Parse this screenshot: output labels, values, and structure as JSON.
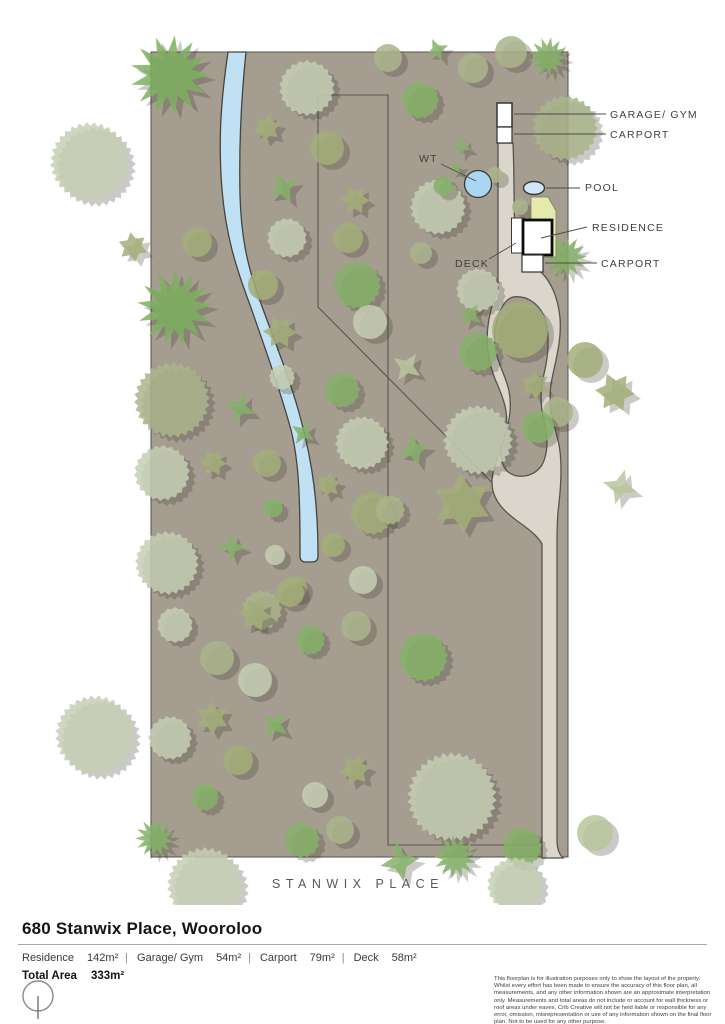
{
  "footer": {
    "title": "680 Stanwix Place, Wooroloo",
    "areas": [
      {
        "label": "Residence",
        "value": "142m²"
      },
      {
        "label": "Garage/ Gym",
        "value": "54m²"
      },
      {
        "label": "Carport",
        "value": "79m²"
      },
      {
        "label": "Deck",
        "value": "58m²"
      }
    ],
    "total_label": "Total Area",
    "total_value": "333m²",
    "disclaimer": "This floorplan is for illustration purposes only to show the layout of the property. Whilst every effort has been made to ensure the accuracy of this floor plan, all measurements, and any other information shown are an approximate interpretation only. Measurements and total areas do not include or account for wall thickness or roof areas under eaves. Crib Creative will not be held liable or responsible for any error, omission, misrepresentation or use of any information shown on the final floor plan. Not to be used for any other purpose.",
    "website": "www.cribcreative.com.au"
  },
  "map": {
    "width": 725,
    "height": 905,
    "lot": {
      "x": 151,
      "y": 52,
      "w": 417,
      "h": 805,
      "fill": "#a69d91",
      "stroke": "#55514a"
    },
    "creek_d": "M 228,52 C 221,100 218,140 222,190 C 226,235 235,265 250,305 C 264,345 280,390 291,430 C 298,458 300,490 300,545 L 300,556 Q 300,562 306,562 L 312,562 Q 318,562 318,556 C 318,505 313,465 301,420 C 290,378 272,335 259,298 C 247,265 241,235 240,195 C 239,150 241,100 246,52 Z",
    "creek_fill": "#bfe1f3",
    "creek_stroke": "#45433d",
    "fence": [
      "M 318,95 L 388,95 L 388,845 L 534,845 Q 542,845 542,836 L 542,535",
      "M 318,95 L 318,307 L 542,533"
    ],
    "fence_stroke": "#5b564e",
    "driveway_d": "M 498,143 L 513,143 C 515,190 513,235 517,252 L 540,252 L 541,272 C 551,282 558,297 560,318 C 562,341 555,362 551,384 C 548,405 553,421 558,440 C 563,460 561,488 558,512 C 557,526 557,534 557,544 L 557,840 C 557,848 559,854 563,858 L 542,858 L 542,544 C 537,535 527,528 516,520 C 501,509 491,497 492,480 C 493,464 502,450 506,431 C 509,412 503,397 495,379 C 488,361 485,340 489,319 C 492,305 494,297 498,290 Z M 513,297 C 527,295 541,304 546,322 C 550,339 548,357 544,374 C 540,390 540,405 544,421 C 548,438 548,454 542,465 C 534,477 517,480 507,471 C 499,462 500,449 505,435 C 510,420 512,406 509,391 C 506,376 497,363 495,346 C 493,326 500,301 513,297 Z",
    "driveway_fill": "#dbd6cc",
    "driveway_stroke": "#57534b",
    "lawn_d": "M 531,197 L 548,197 L 556,211 L 556,257 L 531,257 Z",
    "lawn_fill": "#e4eaac",
    "lawn_stroke": "#77775a",
    "buildings": [
      {
        "name": "garage-gym",
        "x": 497,
        "y": 103,
        "w": 15,
        "h": 24,
        "stroke": "#35332e",
        "sw": 1.5
      },
      {
        "name": "carport-top",
        "x": 497,
        "y": 127,
        "w": 15,
        "h": 16,
        "stroke": "#35332e",
        "sw": 1.2
      },
      {
        "name": "deck",
        "x": 511.5,
        "y": 218,
        "w": 12.5,
        "h": 35,
        "stroke": "#3a3833",
        "sw": 1
      },
      {
        "name": "residence",
        "x": 523,
        "y": 220,
        "w": 29,
        "h": 35,
        "stroke": "#0c0c0c",
        "sw": 2.8
      },
      {
        "name": "carport-low",
        "x": 522,
        "y": 255,
        "w": 21,
        "h": 17,
        "stroke": "#35332e",
        "sw": 1.2
      }
    ],
    "pool": {
      "cx": 534,
      "cy": 188,
      "rx": 10.5,
      "ry": 6.5,
      "fill": "#cfe7f6",
      "stroke": "#3a3833"
    },
    "wt": {
      "cx": 478,
      "cy": 184,
      "r": 13.5,
      "fill": "#a9d6f0",
      "stroke": "#3a3833"
    },
    "leaders": [
      "M 514,114 L 606,114",
      "M 514,134 L 606,134",
      "M 546,188 L 580,188",
      "M 541,238 L 587,227",
      "M 545,263 L 597,263",
      "M 489,259 L 516,243",
      "M 441,164 L 476,181"
    ],
    "leader_stroke": "#4e4b45",
    "labels": [
      {
        "name": "label-garage-gym",
        "text": "GARAGE/ GYM",
        "x": 610,
        "y": 118,
        "fs": 10.5,
        "ls": 1.2,
        "fill": "#403e38",
        "anchor": "start"
      },
      {
        "name": "label-carport-top",
        "text": "CARPORT",
        "x": 610,
        "y": 138,
        "fs": 10.5,
        "ls": 1.2,
        "fill": "#403e38",
        "anchor": "start"
      },
      {
        "name": "label-pool",
        "text": "POOL",
        "x": 585,
        "y": 191,
        "fs": 10.5,
        "ls": 1.2,
        "fill": "#403e38",
        "anchor": "start"
      },
      {
        "name": "label-residence",
        "text": "RESIDENCE",
        "x": 592,
        "y": 231,
        "fs": 10.5,
        "ls": 1.2,
        "fill": "#403e38",
        "anchor": "start"
      },
      {
        "name": "label-carport-low",
        "text": "CARPORT",
        "x": 601,
        "y": 267,
        "fs": 10.5,
        "ls": 1.2,
        "fill": "#403e38",
        "anchor": "start"
      },
      {
        "name": "label-deck",
        "text": "DECK",
        "x": 455,
        "y": 267,
        "fs": 10.5,
        "ls": 1.2,
        "fill": "#403e38",
        "anchor": "start"
      },
      {
        "name": "label-wt",
        "text": "WT",
        "x": 419,
        "y": 162,
        "fs": 10.5,
        "ls": 1.2,
        "fill": "#403e38",
        "anchor": "start"
      },
      {
        "name": "label-road",
        "text": "STANWIX PLACE",
        "x": 358,
        "y": 888,
        "fs": 12.5,
        "ls": 5.5,
        "fill": "#5c584f",
        "anchor": "middle"
      }
    ],
    "tree_colors": {
      "P": "#c6cfb4",
      "S": "#aab58c",
      "O": "#a3ae79",
      "G": "#85b169",
      "B": "#7cb05f",
      "PG": "#b9c79b"
    },
    "trees": [
      [
        170,
        75,
        40,
        "b",
        "B"
      ],
      [
        90,
        162,
        40,
        "s",
        "P"
      ],
      [
        133,
        247,
        15,
        "s6",
        "O"
      ],
      [
        197,
        242,
        15,
        "c",
        "O"
      ],
      [
        175,
        308,
        38,
        "b",
        "B"
      ],
      [
        172,
        400,
        38,
        "s",
        "S"
      ],
      [
        162,
        473,
        28,
        "s",
        "P"
      ],
      [
        167,
        563,
        32,
        "s",
        "P"
      ],
      [
        95,
        735,
        40,
        "s",
        "P"
      ],
      [
        170,
        738,
        22,
        "s",
        "P"
      ],
      [
        307,
        88,
        28,
        "s",
        "P"
      ],
      [
        388,
        58,
        14,
        "c",
        "S"
      ],
      [
        420,
        100,
        19,
        "s",
        "G"
      ],
      [
        267,
        128,
        14,
        "s6",
        "O"
      ],
      [
        327,
        148,
        17,
        "c",
        "O"
      ],
      [
        283,
        188,
        17,
        "s4",
        "G"
      ],
      [
        287,
        238,
        20,
        "s",
        "P"
      ],
      [
        348,
        238,
        15,
        "c",
        "O"
      ],
      [
        355,
        200,
        15,
        "s6",
        "O"
      ],
      [
        357,
        285,
        24,
        "s",
        "G"
      ],
      [
        263,
        285,
        15,
        "c",
        "O"
      ],
      [
        280,
        332,
        17,
        "s6",
        "O"
      ],
      [
        370,
        322,
        17,
        "c",
        "P"
      ],
      [
        240,
        408,
        16,
        "s4",
        "G"
      ],
      [
        213,
        463,
        14,
        "s6",
        "O"
      ],
      [
        267,
        463,
        14,
        "c",
        "O"
      ],
      [
        273,
        508,
        10,
        "s",
        "G"
      ],
      [
        232,
        547,
        14,
        "s4",
        "G"
      ],
      [
        275,
        555,
        10,
        "c",
        "P"
      ],
      [
        282,
        377,
        13,
        "s",
        "P"
      ],
      [
        303,
        433,
        13,
        "s4",
        "G"
      ],
      [
        328,
        485,
        13,
        "s6",
        "O"
      ],
      [
        342,
        390,
        18,
        "s",
        "G"
      ],
      [
        362,
        443,
        27,
        "s",
        "P"
      ],
      [
        372,
        513,
        22,
        "s",
        "O"
      ],
      [
        333,
        545,
        12,
        "c",
        "O"
      ],
      [
        363,
        580,
        14,
        "c",
        "P"
      ],
      [
        295,
        588,
        12,
        "c",
        "O"
      ],
      [
        262,
        610,
        20,
        "s",
        "S"
      ],
      [
        407,
        367,
        16,
        "s4",
        "PG"
      ],
      [
        414,
        450,
        17,
        "s4",
        "G"
      ],
      [
        390,
        510,
        15,
        "s",
        "S"
      ],
      [
        438,
        207,
        28,
        "s",
        "P"
      ],
      [
        421,
        253,
        11,
        "c",
        "S"
      ],
      [
        478,
        290,
        22,
        "s",
        "P"
      ],
      [
        473,
        68,
        15,
        "c",
        "S"
      ],
      [
        511,
        52,
        16,
        "c",
        "S"
      ],
      [
        548,
        57,
        20,
        "b",
        "G"
      ],
      [
        565,
        128,
        33,
        "s",
        "S"
      ],
      [
        565,
        257,
        22,
        "b",
        "G"
      ],
      [
        585,
        360,
        18,
        "c",
        "O"
      ],
      [
        615,
        392,
        20,
        "s6",
        "O"
      ],
      [
        620,
        487,
        18,
        "s4",
        "PG"
      ],
      [
        558,
        412,
        15,
        "c",
        "S"
      ],
      [
        520,
        330,
        28,
        "c",
        "O"
      ],
      [
        478,
        352,
        20,
        "s",
        "G"
      ],
      [
        535,
        385,
        15,
        "s6",
        "O"
      ],
      [
        538,
        427,
        16,
        "c",
        "G"
      ],
      [
        478,
        440,
        35,
        "s",
        "P"
      ],
      [
        462,
        503,
        30,
        "s6",
        "O"
      ],
      [
        437,
        50,
        12,
        "s4",
        "G"
      ],
      [
        462,
        147,
        10,
        "s4",
        "G"
      ],
      [
        456,
        168,
        8,
        "s4",
        "G"
      ],
      [
        495,
        175,
        8,
        "c",
        "S"
      ],
      [
        443,
        186,
        10,
        "s",
        "G"
      ],
      [
        520,
        207,
        8,
        "c",
        "S"
      ],
      [
        470,
        315,
        13,
        "s4",
        "G"
      ],
      [
        175,
        625,
        18,
        "s",
        "P"
      ],
      [
        217,
        658,
        17,
        "c",
        "S"
      ],
      [
        255,
        615,
        17,
        "s6",
        "O"
      ],
      [
        290,
        593,
        14,
        "c",
        "O"
      ],
      [
        310,
        640,
        15,
        "s",
        "G"
      ],
      [
        356,
        626,
        15,
        "c",
        "S"
      ],
      [
        255,
        680,
        17,
        "c",
        "P"
      ],
      [
        212,
        718,
        17,
        "s6",
        "O"
      ],
      [
        275,
        725,
        15,
        "s4",
        "G"
      ],
      [
        238,
        760,
        15,
        "c",
        "O"
      ],
      [
        205,
        797,
        14,
        "s",
        "G"
      ],
      [
        315,
        795,
        13,
        "c",
        "P"
      ],
      [
        355,
        770,
        16,
        "s6",
        "O"
      ],
      [
        302,
        840,
        18,
        "s",
        "G"
      ],
      [
        340,
        830,
        14,
        "c",
        "S"
      ],
      [
        423,
        657,
        25,
        "s",
        "G"
      ],
      [
        452,
        797,
        45,
        "s",
        "P"
      ],
      [
        522,
        847,
        20,
        "s",
        "G"
      ],
      [
        400,
        862,
        20,
        "s4",
        "G"
      ],
      [
        455,
        857,
        22,
        "b",
        "G"
      ],
      [
        595,
        833,
        18,
        "c",
        "PG"
      ],
      [
        155,
        838,
        20,
        "b",
        "G"
      ],
      [
        205,
        885,
        38,
        "s",
        "P"
      ],
      [
        515,
        885,
        28,
        "s",
        "P"
      ]
    ]
  }
}
